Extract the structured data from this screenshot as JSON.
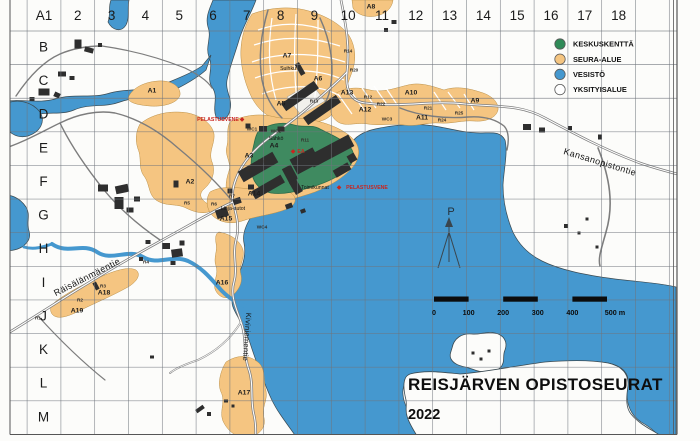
{
  "map": {
    "title": "REISJÄRVEN OPISTOSEURAT",
    "year": "2022",
    "colors": {
      "water": "#4598cf",
      "seura_alue": "#f5c581",
      "keskuskentta": "#3f8a60",
      "yksityisalue": "#ffffff",
      "building": "#2e2e2e",
      "safety_red": "#c9251f"
    },
    "legend": {
      "items": [
        {
          "name": "keskuskentta",
          "label": "KESKUSKENTTÄ",
          "color": "#2f8a57"
        },
        {
          "name": "seura-alue",
          "label": "SEURA-ALUE",
          "color": "#f5c581"
        },
        {
          "name": "vesisto",
          "label": "VESISTÖ",
          "color": "#4598cf"
        },
        {
          "name": "yksityisalue",
          "label": "YKSITYISALUE",
          "color": "#ffffff"
        }
      ]
    },
    "scale_bar": {
      "ticks": [
        "0",
        "100",
        "200",
        "300",
        "400",
        "500 m"
      ]
    },
    "grid": {
      "columns": [
        "A1",
        "2",
        "3",
        "4",
        "5",
        "6",
        "7",
        "8",
        "9",
        "10",
        "11",
        "12",
        "13",
        "14",
        "15",
        "16",
        "17",
        "18"
      ],
      "rows": [
        "B",
        "C",
        "D",
        "E",
        "F",
        "G",
        "H",
        "I",
        "J",
        "K",
        "L",
        "M"
      ]
    },
    "compass_label": "P",
    "labels": [
      {
        "t": "A1",
        "x": 152,
        "y": 91,
        "c": "area"
      },
      {
        "t": "A2",
        "x": 190,
        "y": 182,
        "c": "area"
      },
      {
        "t": "A3",
        "x": 249,
        "y": 156,
        "c": "area"
      },
      {
        "t": "A4",
        "x": 274,
        "y": 146,
        "c": "area"
      },
      {
        "t": "A5",
        "x": 281,
        "y": 104,
        "c": "area"
      },
      {
        "t": "A6",
        "x": 318,
        "y": 79,
        "c": "area"
      },
      {
        "t": "A7",
        "x": 287,
        "y": 56,
        "c": "area"
      },
      {
        "t": "A8",
        "x": 371,
        "y": 7,
        "c": "area"
      },
      {
        "t": "A9",
        "x": 475,
        "y": 101,
        "c": "area"
      },
      {
        "t": "A10",
        "x": 411,
        "y": 93,
        "c": "area"
      },
      {
        "t": "A11",
        "x": 422,
        "y": 118,
        "c": "area"
      },
      {
        "t": "A12",
        "x": 365,
        "y": 110,
        "c": "area"
      },
      {
        "t": "A13",
        "x": 347,
        "y": 93,
        "c": "area"
      },
      {
        "t": "A14",
        "x": 254,
        "y": 194,
        "c": "area"
      },
      {
        "t": "A15",
        "x": 226,
        "y": 219,
        "c": "area"
      },
      {
        "t": "A16",
        "x": 222,
        "y": 283,
        "c": "area"
      },
      {
        "t": "A17",
        "x": 244,
        "y": 393,
        "c": "area"
      },
      {
        "t": "A18",
        "x": 104,
        "y": 293,
        "c": "area"
      },
      {
        "t": "A19",
        "x": 77,
        "y": 311,
        "c": "area"
      },
      {
        "t": "R1",
        "x": 38,
        "y": 318,
        "c": "small"
      },
      {
        "t": "R2",
        "x": 80,
        "y": 300,
        "c": "small"
      },
      {
        "t": "R3",
        "x": 103,
        "y": 286,
        "c": "small"
      },
      {
        "t": "R4",
        "x": 146,
        "y": 262,
        "c": "small"
      },
      {
        "t": "R5",
        "x": 187,
        "y": 203,
        "c": "small"
      },
      {
        "t": "R6",
        "x": 214,
        "y": 204,
        "c": "small"
      },
      {
        "t": "R7",
        "x": 232,
        "y": 196,
        "c": "small"
      },
      {
        "t": "R9",
        "x": 249,
        "y": 171,
        "c": "small"
      },
      {
        "t": "R10",
        "x": 262,
        "y": 161,
        "c": "small"
      },
      {
        "t": "R11",
        "x": 305,
        "y": 140,
        "c": "small"
      },
      {
        "t": "R12",
        "x": 368,
        "y": 97,
        "c": "small"
      },
      {
        "t": "R13",
        "x": 314,
        "y": 101,
        "c": "small"
      },
      {
        "t": "R14",
        "x": 348,
        "y": 51,
        "c": "small"
      },
      {
        "t": "R20",
        "x": 354,
        "y": 70,
        "c": "small"
      },
      {
        "t": "R21",
        "x": 428,
        "y": 108,
        "c": "small"
      },
      {
        "t": "R22",
        "x": 381,
        "y": 104,
        "c": "small"
      },
      {
        "t": "R24",
        "x": 442,
        "y": 120,
        "c": "small"
      },
      {
        "t": "R25",
        "x": 459,
        "y": 113,
        "c": "small"
      },
      {
        "t": "WC1",
        "x": 252,
        "y": 129,
        "c": "small"
      },
      {
        "t": "WC2",
        "x": 276,
        "y": 131,
        "c": "small"
      },
      {
        "t": "WC3",
        "x": 387,
        "y": 119,
        "c": "small"
      },
      {
        "t": "WC4",
        "x": 262,
        "y": 227,
        "c": "small"
      },
      {
        "t": "Sähkö",
        "x": 276,
        "y": 139,
        "c": "name"
      },
      {
        "t": "Suihku",
        "x": 288,
        "y": 69,
        "c": "name"
      },
      {
        "t": "Linja-autot",
        "x": 233,
        "y": 209,
        "c": "name"
      },
      {
        "t": "Toimikunnat",
        "x": 315,
        "y": 188,
        "c": "name"
      },
      {
        "t": "PELASTUSVENE",
        "x": 218,
        "y": 120,
        "c": "red"
      },
      {
        "t": "PELASTUSVENE",
        "x": 367,
        "y": 188,
        "c": "red"
      },
      {
        "t": "EA",
        "x": 301,
        "y": 152,
        "c": "red"
      },
      {
        "t": "◆",
        "x": 242,
        "y": 120,
        "c": "marker"
      },
      {
        "t": "◆",
        "x": 339,
        "y": 188,
        "c": "marker"
      },
      {
        "t": "◆",
        "x": 293,
        "y": 152,
        "c": "marker"
      },
      {
        "t": "Kansanopistontie",
        "x": 600,
        "y": 162,
        "c": "street",
        "r": 17
      },
      {
        "t": "Räisälänmäentie",
        "x": 87,
        "y": 277,
        "c": "street",
        "r": -27
      },
      {
        "t": "Kiviniementie",
        "x": 247,
        "y": 337,
        "c": "street-sm",
        "r": 94
      }
    ]
  }
}
